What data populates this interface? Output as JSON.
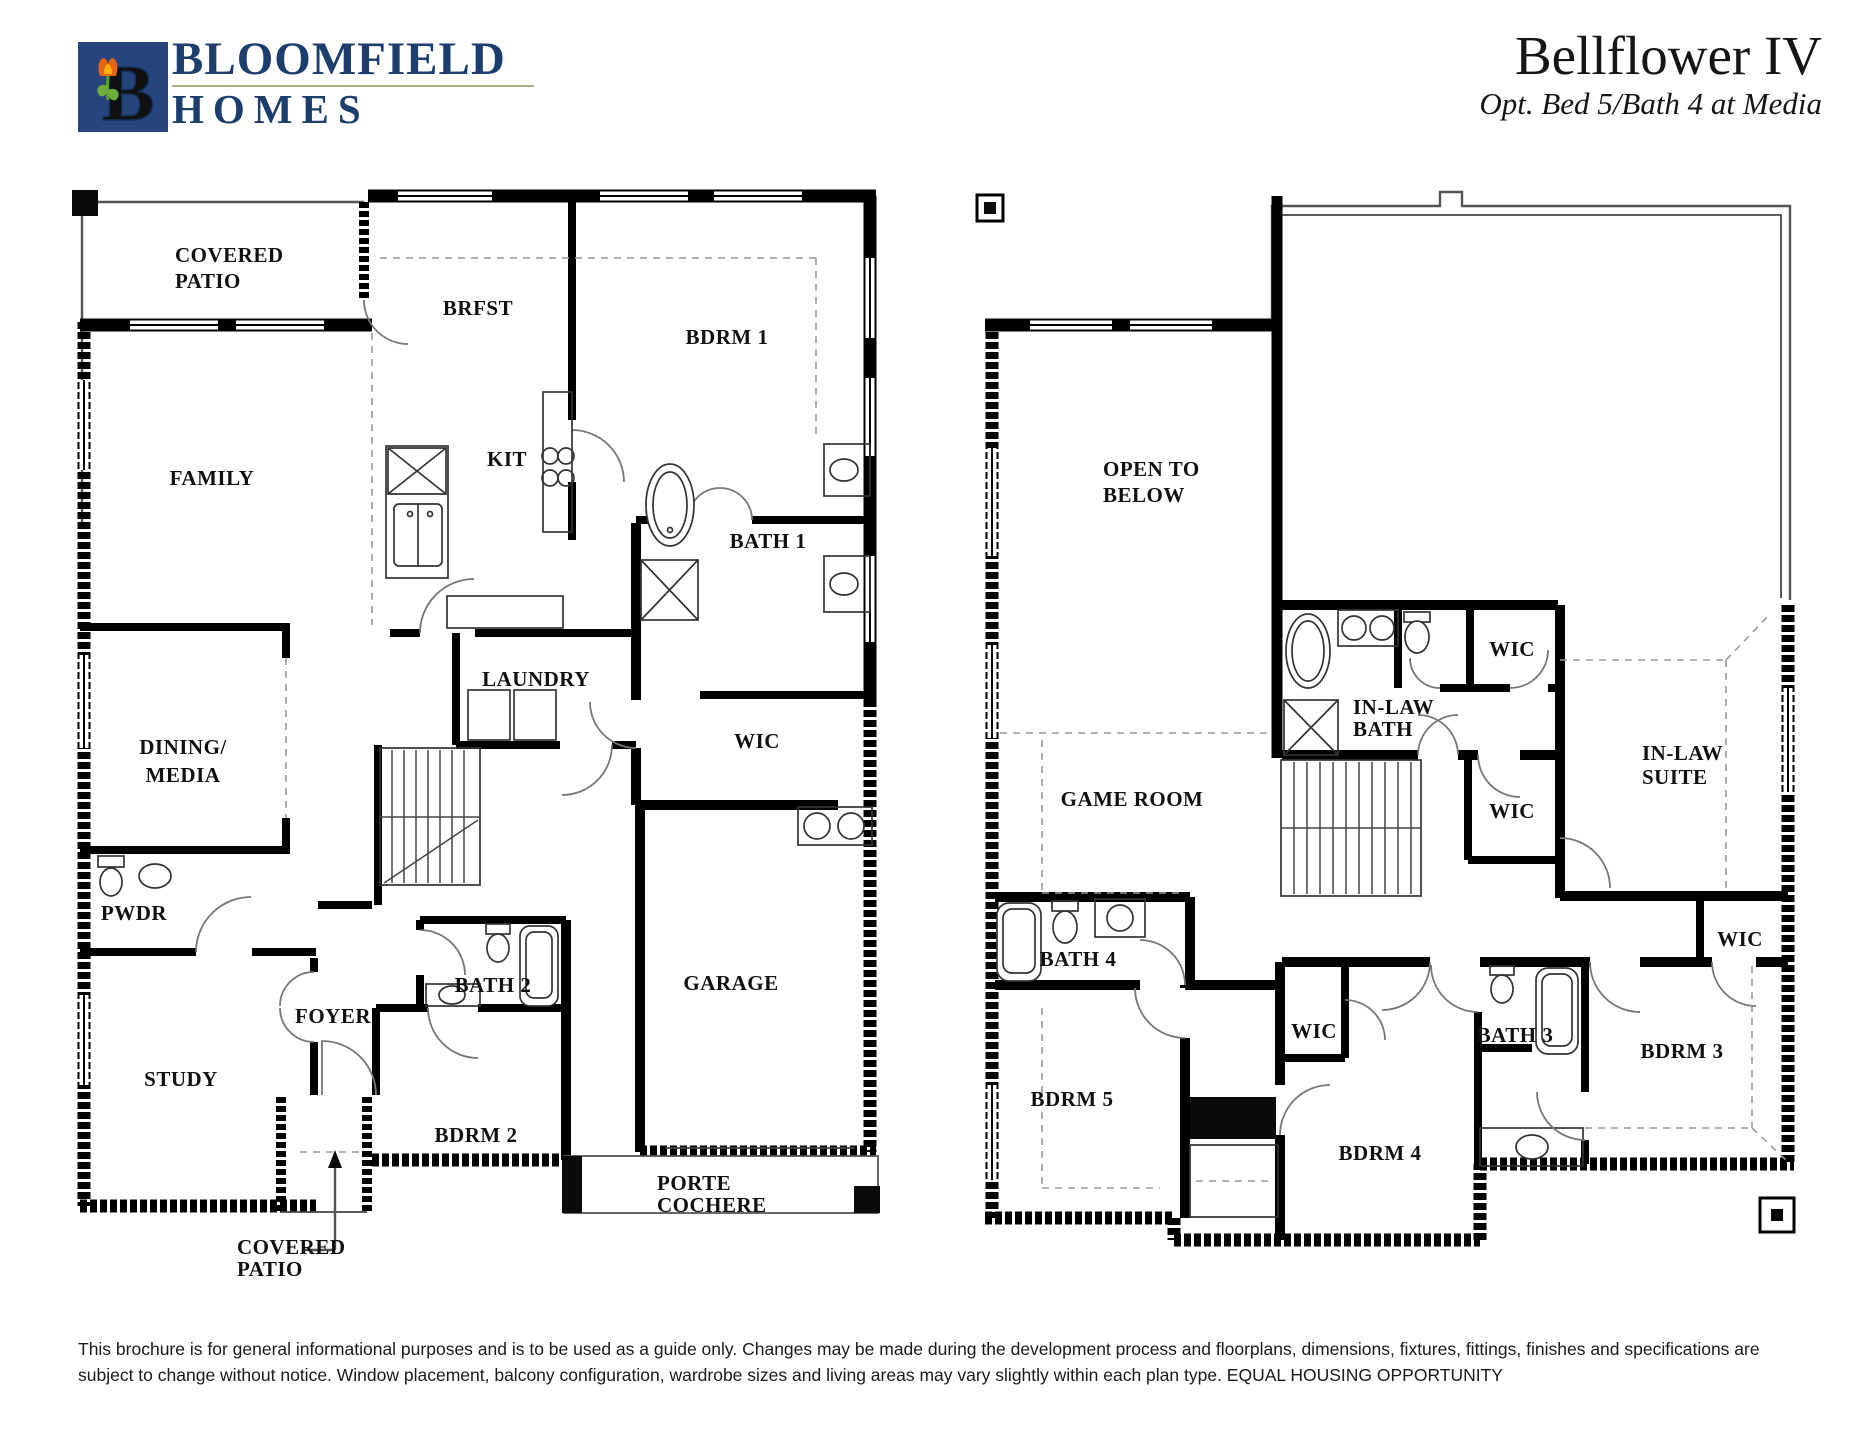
{
  "header": {
    "logo": {
      "letter": "B",
      "icon": "tulip-logo-icon",
      "square_color": "#26457c",
      "letter_color": "#76b043",
      "tulip_color": "#e8650d"
    },
    "brand_line1": "BLOOMFIELD",
    "brand_line2": "HOMES",
    "title": "Bellflower IV",
    "subtitle": "Opt. Bed 5/Bath 4 at Media"
  },
  "first_floor": {
    "rooms": {
      "covered_patio_top_1": "COVERED",
      "covered_patio_top_2": "PATIO",
      "family": "FAMILY",
      "brfst": "BRFST",
      "kit": "KIT",
      "bdrm1": "BDRM 1",
      "bath1": "BATH 1",
      "laundry": "LAUNDRY",
      "wic": "WIC",
      "dining_1": "DINING/",
      "dining_2": "MEDIA",
      "pwdr": "PWDR",
      "bath2": "BATH 2",
      "foyer": "FOYER",
      "study": "STUDY",
      "bdrm2": "BDRM 2",
      "garage": "GARAGE",
      "porte_1": "PORTE",
      "porte_2": "COCHERE",
      "covered_patio_bottom_1": "COVERED",
      "covered_patio_bottom_2": "PATIO"
    }
  },
  "second_floor": {
    "rooms": {
      "open_below_1": "OPEN TO",
      "open_below_2": "BELOW",
      "game_room": "GAME ROOM",
      "inlaw_bath_1": "IN-LAW",
      "inlaw_bath_2": "BATH",
      "wic_top": "WIC",
      "wic_mid": "WIC",
      "inlaw_suite_1": "IN-LAW",
      "inlaw_suite_2": "SUITE",
      "wic_right": "WIC",
      "bath4": "BATH 4",
      "bdrm5": "BDRM 5",
      "wic_bdrm4": "WIC",
      "bdrm4": "BDRM 4",
      "bath3": "BATH 3",
      "bdrm3": "BDRM 3"
    }
  },
  "footer": {
    "line1": "This brochure is for general informational purposes and is to be used as a guide only. Changes may be made during the development process and floorplans, dimensions, fixtures, fittings, finishes and specifications are",
    "line2": "subject to change without notice. Window placement, balcony configuration, wardrobe sizes and living areas may vary slightly within each plan type.  EQUAL HOUSING OPPORTUNITY"
  }
}
